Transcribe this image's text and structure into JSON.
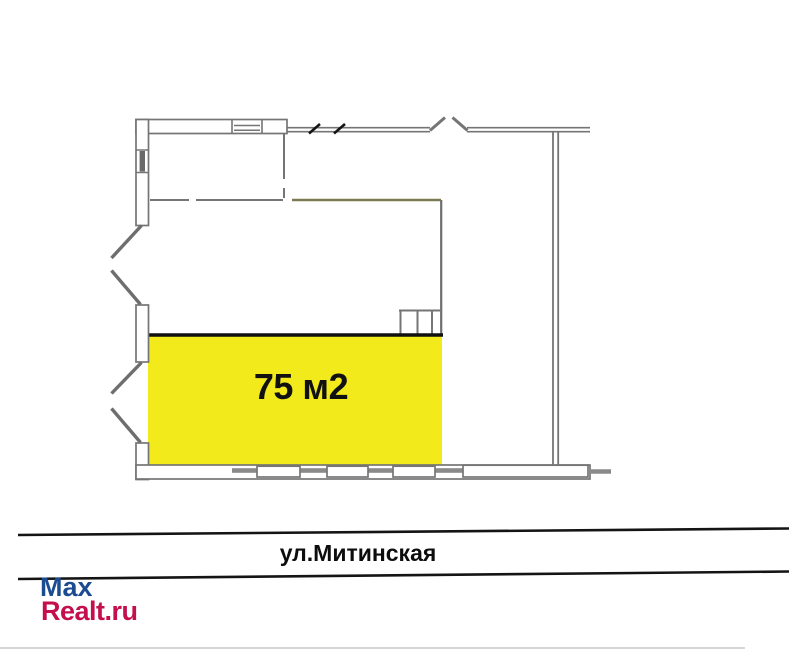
{
  "floorplan": {
    "area_label": "75 м2",
    "street_label": "ул.Митинская",
    "watermark": {
      "line1": "Max",
      "line2": "Realt.ru"
    },
    "colors": {
      "highlight": "#f2ea1a",
      "highlight_border": "#101010",
      "wall_gray": "#757575",
      "wall_dark_gray": "#6e6e6e",
      "window_sill_gray": "#8a8a8a",
      "interior_olive_line": "#7c7a52",
      "street_line_black": "#141414",
      "watermark_blue": "#1b4c91",
      "watermark_red": "#c40e4e"
    }
  }
}
